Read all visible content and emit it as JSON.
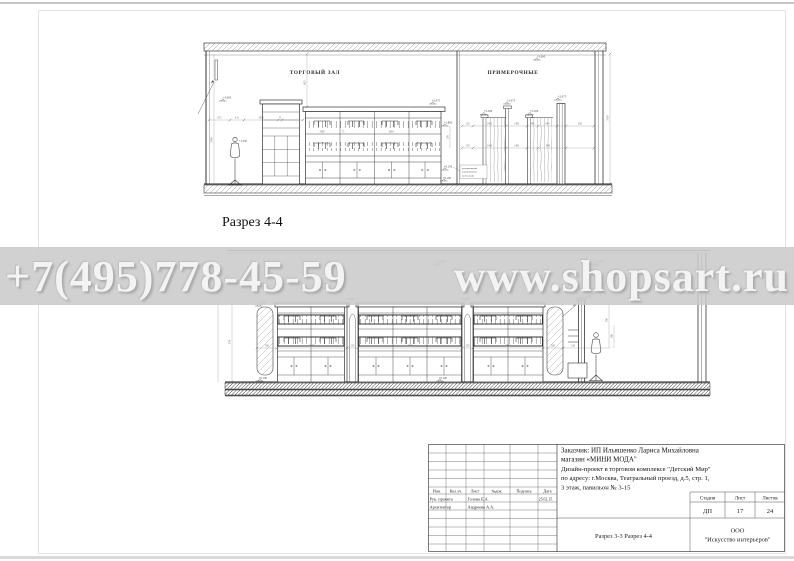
{
  "watermark": {
    "phone": "+7(495)778-45-59",
    "site": "www.shopsart.ru"
  },
  "colors": {
    "watermark_band": "#cbcbcb",
    "watermark_text": "#f3f3f3",
    "drawing_line": "#3c3c3c",
    "dim_text": "#666666"
  },
  "sections": {
    "top_label": "Разрез 4-4"
  },
  "drawing_top": {
    "label_hall": "ТОРГОВЫЙ ЗАЛ",
    "label_fitting": "ПРИМЕРОЧНЫЕ",
    "elevations": [
      "+3.060",
      "+3.000",
      "+2.075",
      "+1.800",
      "+0.100",
      "+2.500",
      "+2.075",
      "+2.500",
      "+2.075",
      "+1.350",
      "+0.100"
    ],
    "dims_h": [
      "675",
      "415",
      "1000",
      "75",
      "150",
      "1462",
      "1300",
      "492",
      "940",
      "635"
    ],
    "dims_v": [
      "2900",
      "1425",
      "7530",
      "250"
    ],
    "note_lines": [
      "декоративный",
      "керамогранит,",
      "мебельный"
    ]
  },
  "drawing_bottom": {
    "elevations": [
      "+2.075",
      "+2.400",
      "+1.800",
      "+1.800",
      "+0.100",
      "+0.100",
      "+1.800",
      "+2.075"
    ],
    "dims_h": [
      "500",
      "2050",
      "250",
      "2050",
      "250",
      "2050",
      "500",
      "528"
    ],
    "dims_v": [
      "574",
      "700",
      "300"
    ]
  },
  "title_block": {
    "customer_line1": "Заказчик:  ИП Ильяшенко Лариса Михайловна",
    "customer_line2": "магазин «МИНИ МОДА\"",
    "project_line1": "Дизайн-проект в  торговом  комплексе \"Детский Мир\"",
    "project_line2": "по адресу: г.Москва, Театральный проезд, д.5, стр. 1,",
    "project_line3": "3 этаж, павильон № 3-15",
    "columns": [
      "Изм.",
      "Кол.уч.",
      "Лист",
      "№док.",
      "Подпись",
      "Дата"
    ],
    "rows": [
      {
        "role": "Рук. проекта",
        "name": "Голова Е.А.",
        "date": "25.02.15."
      },
      {
        "role": "Архитектор",
        "name": "Андреева А.А.",
        "date": ""
      }
    ],
    "stage_label": "Стадия",
    "sheet_label": "Лист",
    "sheets_label": "Листов",
    "stage": "ДП",
    "sheet": "17",
    "sheets": "24",
    "title": "Разрез 3-3 Разрез 4-4",
    "company_line1": "ООО",
    "company_line2": "\"Искусство интерьеров\""
  }
}
